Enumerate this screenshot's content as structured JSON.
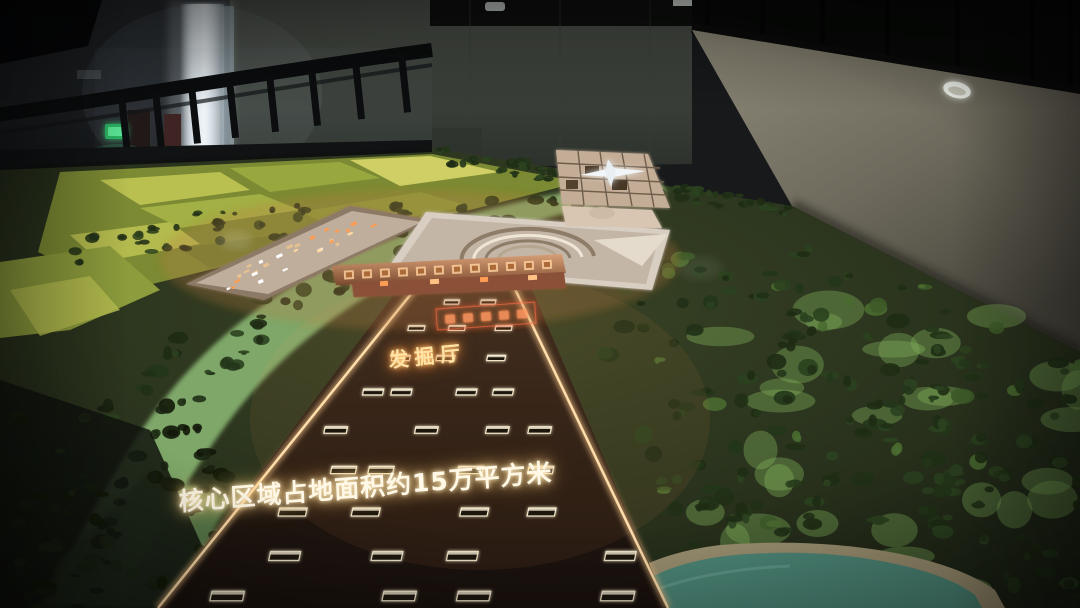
{
  "photo": {
    "title": "exhibition-hall-site-model-photo",
    "setting": "dark indoor exhibition hall, mezzanine railing and walls around a large illuminated terrain model",
    "subject": "architectural scale model of a heritage site core area with central excavation axis"
  },
  "texts": {
    "main_caption": "核心区域占地面积约15万平方米",
    "excavation_hall_label": "发掘厅"
  },
  "signs": {
    "exit_sign": "green emergency exit sign",
    "axis_plaque": "small illuminated plaque with illegible red-glowing characters",
    "gate_band": "embossed copper-lit band with illegible relief characters"
  },
  "palette": {
    "room_shadow": "#0a0a0b",
    "far_wall": "#454a44",
    "right_wall": "#847f6e",
    "doorway_light": "#eef4f6",
    "exit_green": "#2fd36e",
    "farmland_yellow": "#a8b244",
    "meadow_green": "#83ad6d",
    "forest_dark": "#24361a",
    "plaza_brown": "#241a13",
    "plaza_edge_glow": "#ffdfae",
    "pit_outline": "#f2e6c8",
    "pond_teal": "#4d8878",
    "model_beige": "#cdbba6",
    "caption_glow": "#ffe9b8",
    "label_glow": "#ffb25e"
  }
}
